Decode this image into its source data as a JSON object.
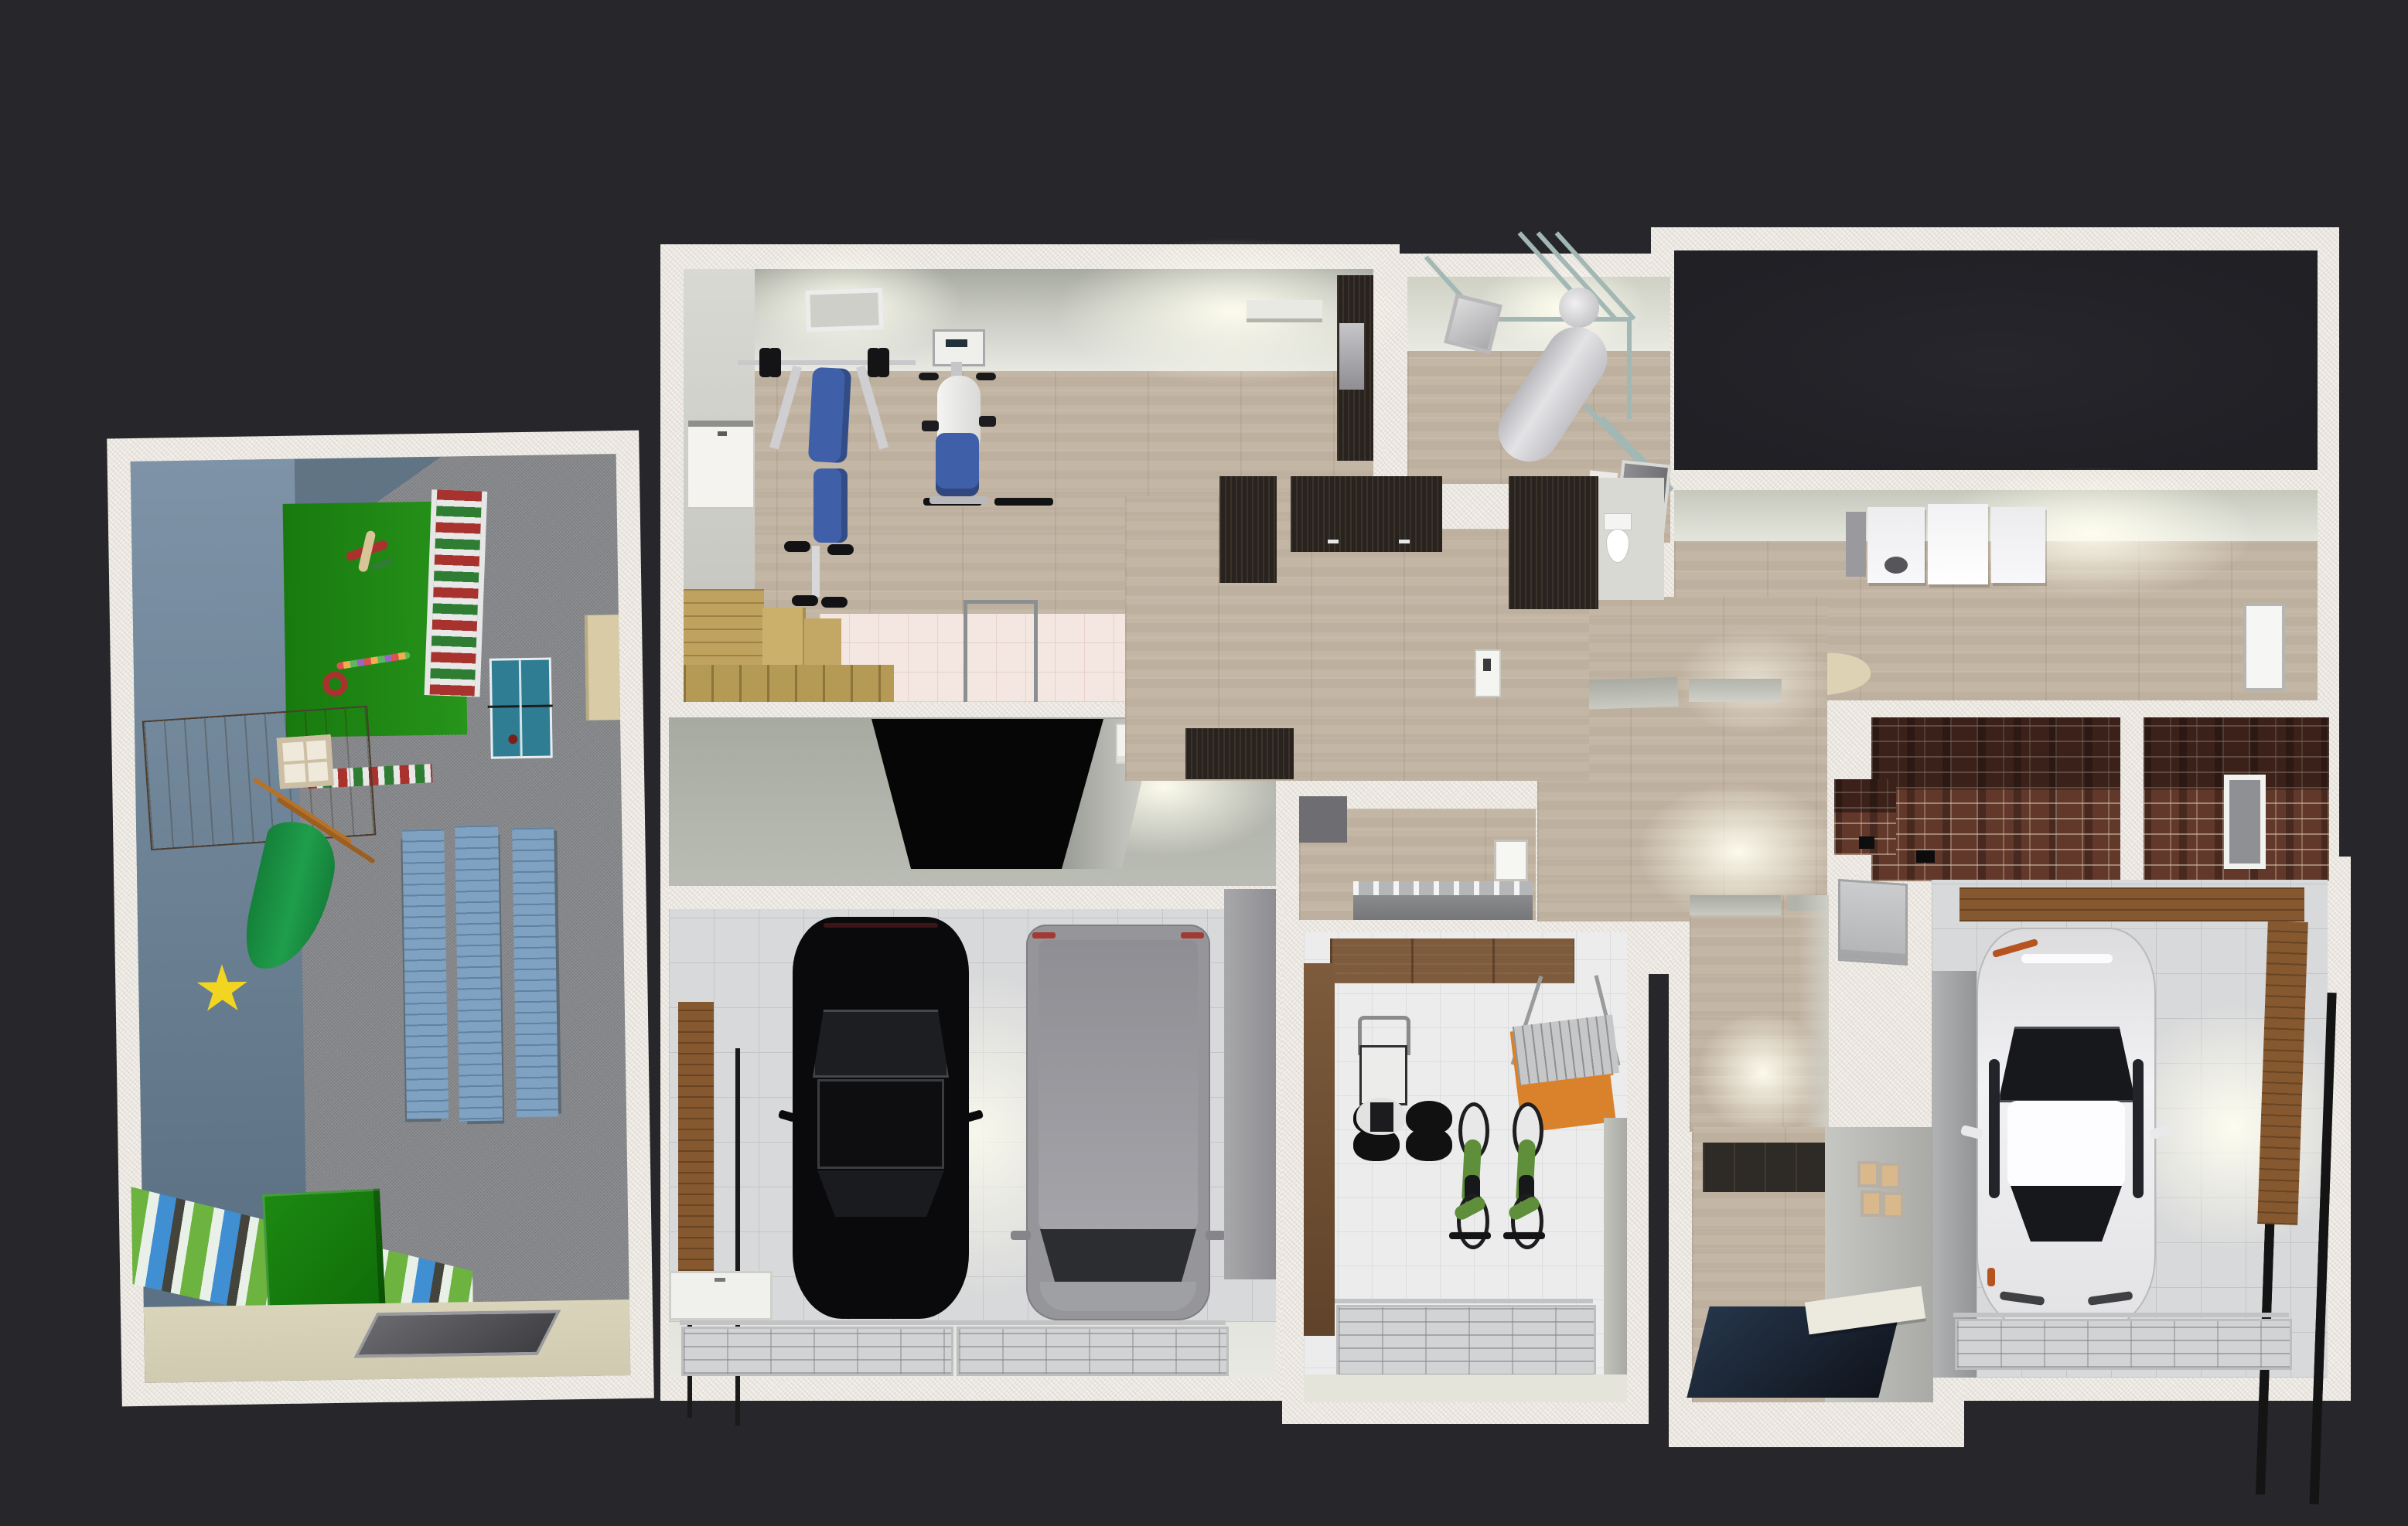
{
  "app": {
    "type": "3D home-design floor plan render",
    "view": "aerial dollhouse view, single storey, no visible UI chrome",
    "background": "#26262b"
  },
  "colors": {
    "bg": "#26262b",
    "wall": "#f2efea",
    "wood": "#c4b6a5",
    "carpet": "#87898c",
    "tile": "#d8d9da",
    "tile-line": "#c4c5c7",
    "blue-wall": "#7e93a7",
    "blue-wall-dark": "#5c7284",
    "green-rug": "#27941b",
    "green-rug-dark": "#187a0e",
    "ladder-red": "#a8332e",
    "ladder-green": "#2e7d32",
    "pingpong": "#2f7d92",
    "playhouse": "#6a5846",
    "playhouse-light": "#8a765d",
    "slide-green": "#1f9e4b",
    "star-yellow": "#f2d521",
    "plank-blue": "#7fa2c2",
    "mural-green": "#6db33f",
    "mural-blue": "#3f8fd2",
    "green-box": "#157a0e",
    "beige-floor": "#d9d4ba",
    "hatch-gray": "#55555a",
    "cab-beige": "#d8cba6",
    "gym-blue": "#3f5fa8",
    "metal": "#c9c9cc",
    "sauna-wood": "#c0a25f",
    "shower-tile": "#f4e6e0",
    "pipe": "#a3b8b5",
    "tank": "#e3e3e6",
    "dark-cab": "#28231f",
    "brick-mid": "#64392c",
    "white-car": "#ececee",
    "black-car": "#0a0a0c",
    "van-gray": "#95959a",
    "door-panel": "#d2d3d5",
    "shelf-wood": "#85582f",
    "mat-navy": "#1d2733",
    "rack-orange": "#d9822b",
    "bike-green": "#5f8f3a"
  },
  "scene": {
    "rooms": [
      {
        "id": "playroom",
        "name": "Kids playroom",
        "floor": "gray carpet",
        "objects": [
          "blue accent wall",
          "green play rug",
          "wooden toy biplane",
          "red toy ring",
          "toy block caterpillar",
          "wall-bars ladder (red/white/green)",
          "striped floor bars",
          "blue table-tennis table",
          "wooden playhouse with window",
          "green slide",
          "yellow star rug",
          "three blue gym benches",
          "waterfall mural wallpaper",
          "green toy box",
          "beige floor strip",
          "dark floor hatch",
          "beige cabinet"
        ]
      },
      {
        "id": "gym",
        "name": "Home gym",
        "floor": "light oak",
        "objects": [
          "weight bench with barbell",
          "recumbent exercise bike with screen",
          "ceiling vent",
          "wall shelf",
          "black corner cabinet",
          "white side door",
          "sauna wood benches",
          "pink shower tiles",
          "glass shower screen"
        ]
      },
      {
        "id": "garage-main",
        "name": "Double garage",
        "floor": "white tile",
        "objects": [
          "black sedan (top view)",
          "gray van (top view)",
          "two sectional garage doors",
          "wooden wall shelf",
          "white low cabinet",
          "tall gray cabinet",
          "black stairwell opening",
          "white wall cabinet"
        ]
      },
      {
        "id": "boiler-room",
        "name": "Boiler room",
        "floor": "light oak",
        "objects": [
          "cylindrical water heater",
          "teal supply pipes",
          "tilted wall picture",
          "gray door",
          "white side panel"
        ]
      },
      {
        "id": "closet",
        "name": "Walk-in closet / storage",
        "floor": "light oak",
        "objects": [
          "dark wardrobe (left)",
          "dark wardrobe row with handles",
          "door gap",
          "tall dark wardrobe (right)",
          "light switch panel",
          "dark chest"
        ]
      },
      {
        "id": "toilet",
        "name": "WC",
        "floor": "pale tile",
        "objects": [
          "toilet (top view)"
        ]
      },
      {
        "id": "bathroom",
        "name": "Washroom",
        "floor": "light oak",
        "objects": [
          "gray trough sink with faucets",
          "dark gray cabinet",
          "white door"
        ]
      },
      {
        "id": "hallway",
        "name": "Hallway",
        "floor": "light oak",
        "objects": [
          "doorway lintels",
          "ceiling light glow",
          "brick niche",
          "gray electrical panel"
        ]
      },
      {
        "id": "dark-room",
        "name": "Unlit room",
        "floor": "none (black)",
        "objects": []
      },
      {
        "id": "laundry",
        "name": "Laundry room",
        "floor": "light oak",
        "objects": [
          "washing machine",
          "two white cabinets",
          "gray side cabinet",
          "ironing board with iron",
          "white door",
          "ceiling light glow"
        ]
      },
      {
        "id": "cellar-a",
        "name": "Brick cellar room",
        "floor": "brick",
        "objects": [
          "dark brick walls",
          "black floor drain"
        ]
      },
      {
        "id": "cellar-b",
        "name": "Brick cellar room with window",
        "floor": "brick",
        "objects": [
          "dark brick walls",
          "white window frame"
        ]
      },
      {
        "id": "garage-right",
        "name": "Single garage",
        "floor": "white tile",
        "objects": [
          "white car (top view)",
          "L-shaped wooden shelf with beam",
          "sectional garage door",
          "gray partition wall"
        ]
      },
      {
        "id": "shed",
        "name": "Bike shed / garden store",
        "floor": "white tile",
        "objects": [
          "lawn mower",
          "two green bicycles",
          "wall-mounted metal rack with orange brackets",
          "brown cabinets",
          "tall brown side cabinet",
          "sectional garage door"
        ]
      },
      {
        "id": "entry",
        "name": "Entry / mudroom",
        "floor": "light oak",
        "objects": [
          "dark navy floor mat",
          "dark tile wainscot",
          "four framed pictures",
          "white bench"
        ]
      },
      {
        "id": "corridor",
        "name": "Corridor to entry",
        "floor": "light oak",
        "objects": [
          "doorway lintels",
          "ceiling light glow"
        ]
      }
    ]
  }
}
